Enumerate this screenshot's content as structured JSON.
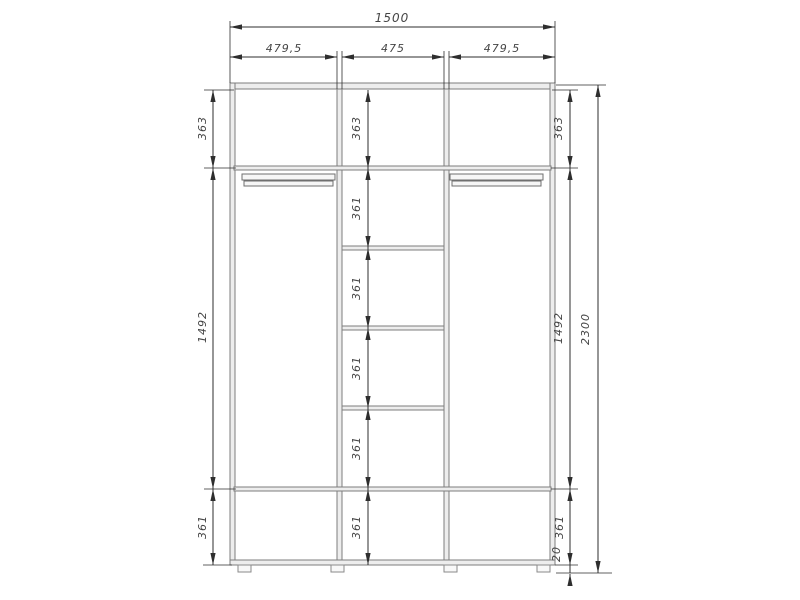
{
  "drawing": {
    "kind": "wardrobe-front-view-dimension-drawing",
    "colors": {
      "background": "#ffffff",
      "panel_fill": "#ededed",
      "panel_stroke": "#7d7d7d",
      "dimension_line": "#2e2e2e",
      "dimension_text": "#454545"
    }
  },
  "dimensions": {
    "total_width": "1500",
    "sections": [
      "479,5",
      "475",
      "479,5"
    ],
    "total_height": "2300",
    "left_column": [
      "363",
      "1492",
      "361"
    ],
    "middle_column": [
      "363",
      "361",
      "361",
      "361",
      "361",
      "361"
    ],
    "right_column": [
      "363",
      "1492",
      "361",
      "20"
    ]
  }
}
